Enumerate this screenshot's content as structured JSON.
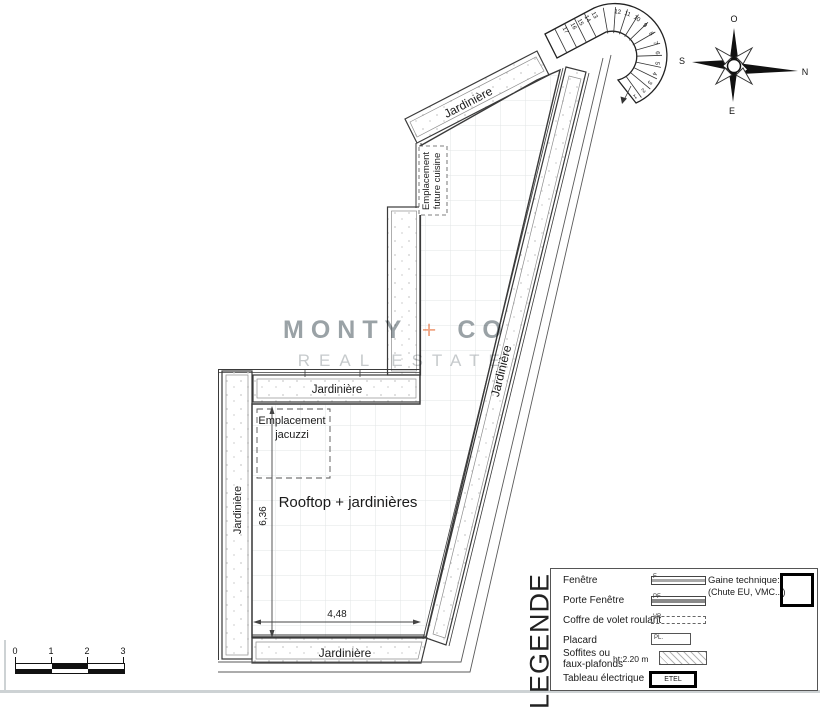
{
  "watermark": {
    "brand_left": "MONTY",
    "brand_plus": "+",
    "brand_right": "CO",
    "subtitle": "REAL ESTATE",
    "accent_color": "#f0a584"
  },
  "compass": {
    "top": "O",
    "right": "N",
    "bottom": "E",
    "left": "S"
  },
  "plan": {
    "labels": {
      "jardiniere": "Jardinière",
      "rooftop": "Rooftop + jardinières",
      "jacuzzi_line1": "Emplacement",
      "jacuzzi_line2": "jacuzzi",
      "cuisine_line1": "Emplacement",
      "cuisine_line2": "future cuisine"
    },
    "dimensions": {
      "vertical": "6,36",
      "horizontal": "4,48"
    },
    "stairs": {
      "numbers": [
        "1",
        "2",
        "3",
        "4",
        "5",
        "6",
        "7",
        "8",
        "9",
        "10",
        "11",
        "12",
        "13",
        "14",
        "15",
        "16",
        "17"
      ]
    }
  },
  "scale_bar": {
    "ticks": [
      "0",
      "1",
      "2",
      "3"
    ]
  },
  "legend": {
    "title": "LEGENDE",
    "items": [
      {
        "label": "Fenêtre",
        "symbol": "F"
      },
      {
        "label": "Porte Fenêtre",
        "symbol": "PF"
      },
      {
        "label": "Coffre de volet roulant",
        "symbol": "VR"
      },
      {
        "label": "Placard",
        "symbol": "PL."
      },
      {
        "label_line1": "Soffites ou",
        "label_line2": "faux-plafonds",
        "note": "ht:2.20 m"
      },
      {
        "label": "Tableau électrique",
        "symbol": "ETEL"
      }
    ],
    "gaine_line1": "Gaine technique:",
    "gaine_line2": "(Chute EU, VMC...)"
  }
}
